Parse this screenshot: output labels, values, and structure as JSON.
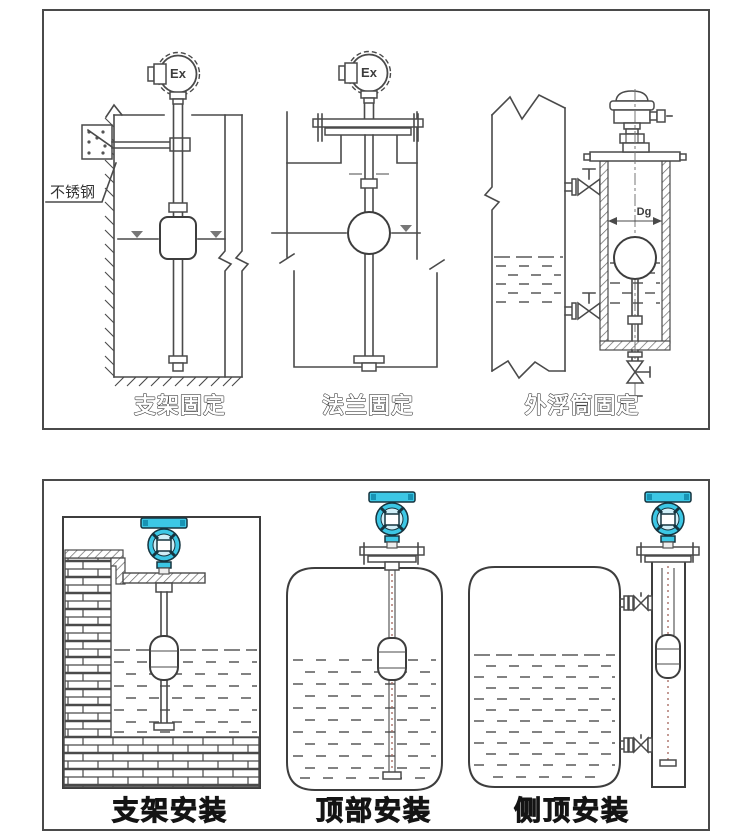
{
  "panels": {
    "top": {
      "captions": [
        "支架固定",
        "法兰固定",
        "外浮筒固定"
      ],
      "labels": {
        "stainless_steel": "不锈钢",
        "ex_marking": "Ex",
        "diameter": "Dg"
      }
    },
    "bottom": {
      "captions": [
        "支架安装",
        "顶部安装",
        "侧顶安装"
      ]
    }
  },
  "colors": {
    "line": "#4a4a4a",
    "panel_border": "#4a4a4a",
    "head_fill": "#3cc7e5",
    "head_stroke": "#16343f",
    "water": "#585858",
    "label_text": "#141414"
  }
}
